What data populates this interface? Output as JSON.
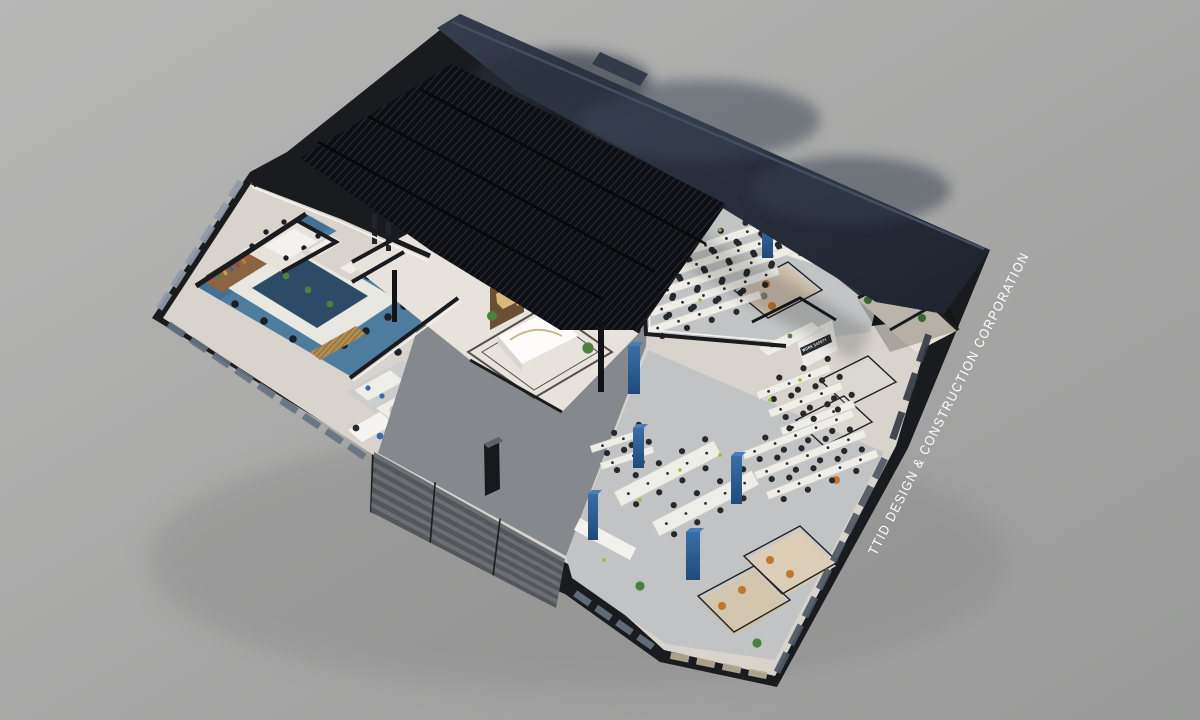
{
  "watermark": {
    "text": "TTID DESIGN & CONSTRUCTION CORPORATION"
  },
  "signs": {
    "work_safety": "WORK SAFETY"
  },
  "palette": {
    "bg_top": "#b6b6b5",
    "bg_bottom": "#9a9b9a",
    "roof_light": "#343b4b",
    "roof_dark": "#1f2430",
    "pergola": "#0d0f13",
    "pergola_line": "#272c36",
    "floor_warm": "#d8d4cd",
    "floor_light": "#e7e3dc",
    "floor_concrete": "#c2c3c4",
    "courtyard": "#85898d",
    "carpet": "#4e7c9e",
    "table_navy": "#2d4a67",
    "wall_cut": "#191b1e",
    "wall_face": "#f4f2ed",
    "glass": "#67727f",
    "glass_bright": "#8f99a6",
    "glass_warm": "#b9ae95",
    "column_blue": "#2e5e93",
    "column_blue_light": "#4a7fb5",
    "wood_shelf": "#8a6542",
    "wood_gold": "#b28d52",
    "desk": "#efede8",
    "chair": "#26282b",
    "chair_tan": "#c0762f",
    "plant": "#4e8040",
    "stair_light": "#6b6f74",
    "stair_dark": "#53565b",
    "text_white": "#ffffff"
  }
}
